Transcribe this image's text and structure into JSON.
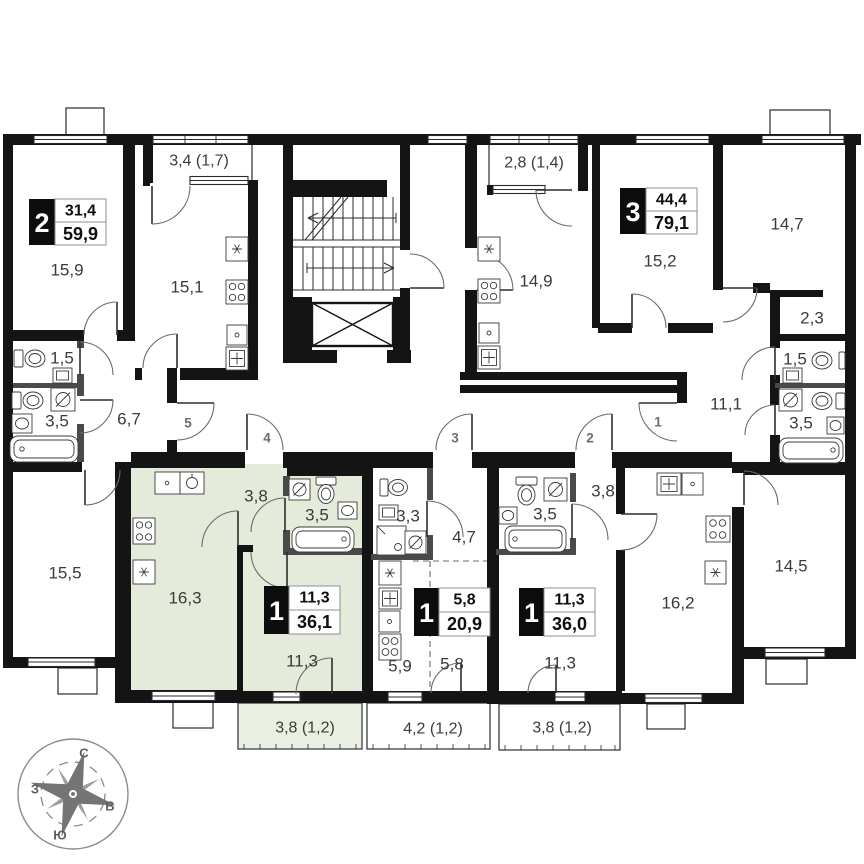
{
  "plan": {
    "apartments": [
      {
        "id": "apt-2room-top-left",
        "badge": "2",
        "living_area": "31,4",
        "total_area": "59,9"
      },
      {
        "id": "apt-3room-right",
        "badge": "3",
        "living_area": "44,4",
        "total_area": "79,1"
      },
      {
        "id": "apt-1room-highlighted",
        "badge": "1",
        "living_area": "11,3",
        "total_area": "36,1"
      },
      {
        "id": "studio-center",
        "badge": "1",
        "living_area": "5,8",
        "total_area": "20,9"
      },
      {
        "id": "apt-1room-center-right",
        "badge": "1",
        "living_area": "11,3",
        "total_area": "36,0"
      }
    ],
    "room_labels": {
      "balcony_top_left": "3,4 (1,7)",
      "room_159": "15,9",
      "kitchen_151": "15,1",
      "balcony_top_right": "2,8 (1,4)",
      "kitchen_149": "14,9",
      "room_152": "15,2",
      "room_147": "14,7",
      "closet_23": "2,3",
      "wc_right": "1,5",
      "bath_right": "3,5",
      "hall_111": "11,1",
      "room_145": "14,5",
      "wc_left": "1,5",
      "bath_left": "3,5",
      "hall_67": "6,7",
      "room_155": "15,5",
      "kitchen_163": "16,3",
      "hall_38_green": "3,8",
      "bath_35_green": "3,5",
      "room_113_green": "11,3",
      "balcony_green": "3,8 (1,2)",
      "bath_33": "3,3",
      "hall_47": "4,7",
      "zone_59": "5,9",
      "zone_58": "5,8",
      "balcony_mid": "4,2 (1,2)",
      "bath_35_center": "3,5",
      "hall_38_center": "3,8",
      "kitchen_162": "16,2",
      "room_113_center": "11,3",
      "balcony_right": "3,8 (1,2)"
    },
    "entrance_numbers": {
      "e1": "1",
      "e2": "2",
      "e3": "3",
      "e4": "4",
      "e5": "5"
    },
    "compass": {
      "north": "С",
      "east": "В",
      "south": "Ю",
      "west": "З"
    },
    "colors": {
      "highlight": "#e4ebdb",
      "wall": "#141414",
      "partition": "#4a4a4a"
    }
  }
}
